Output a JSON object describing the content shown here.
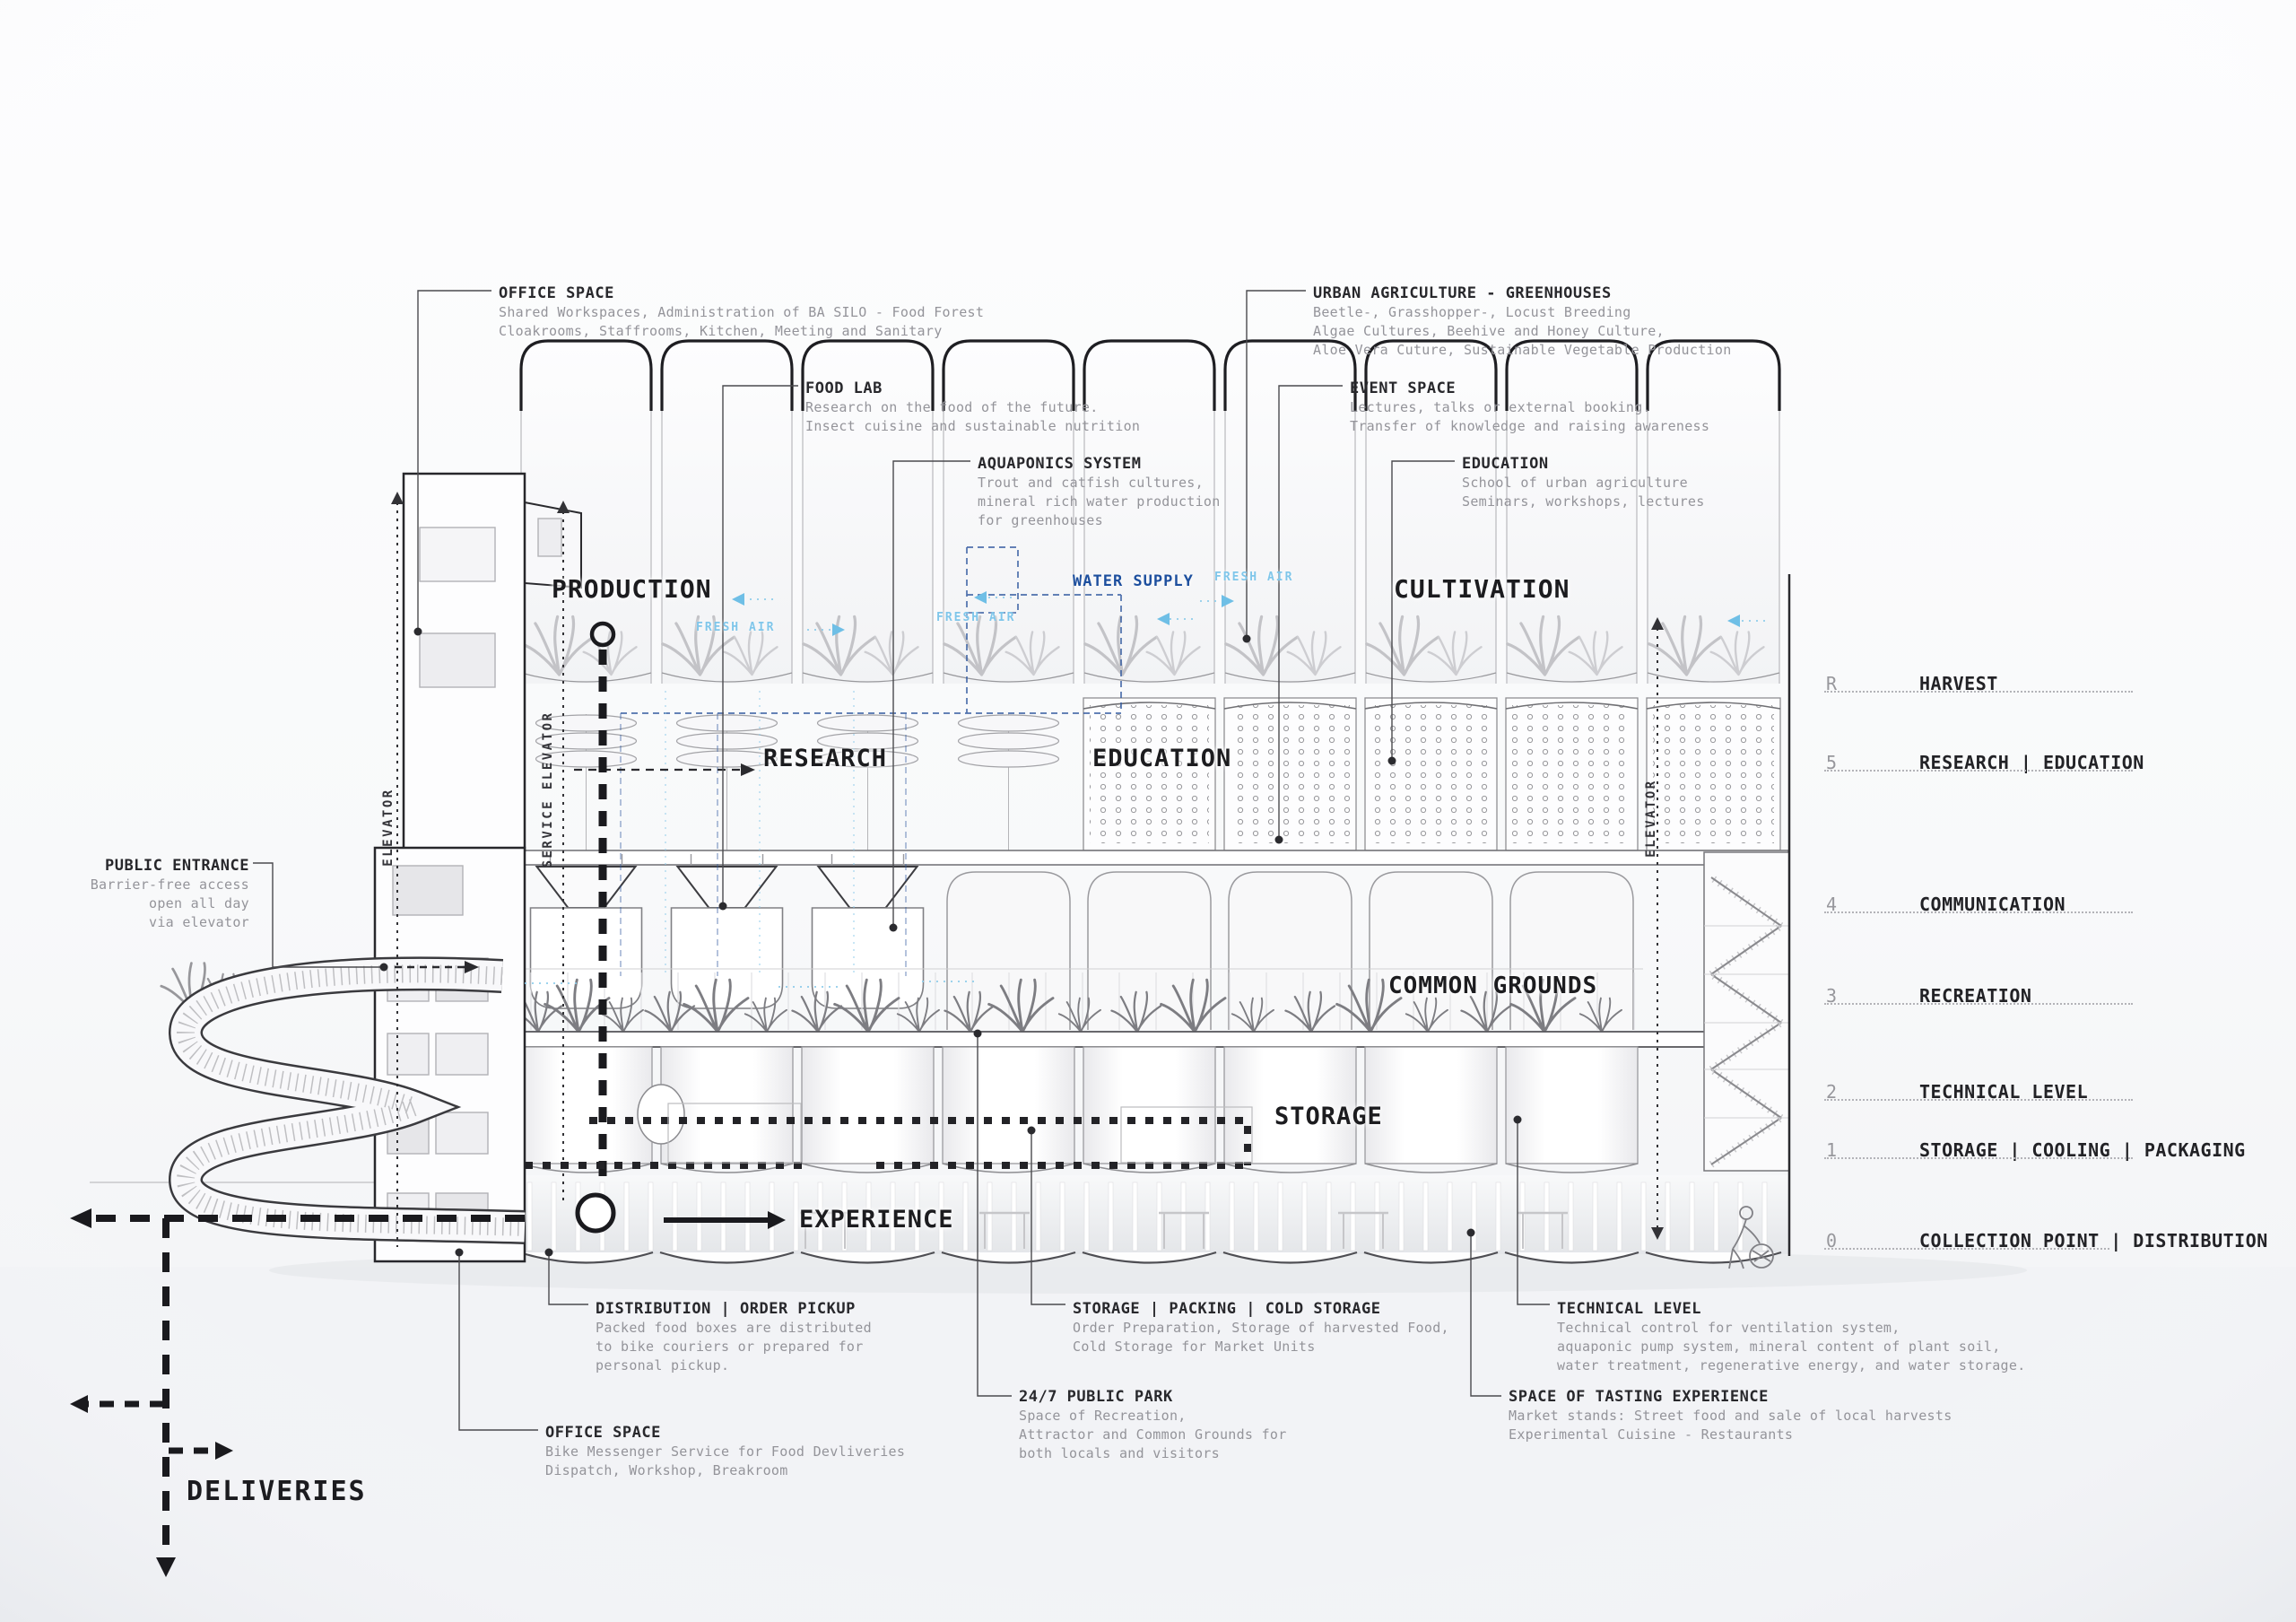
{
  "colors": {
    "accent_navy": "#1d4f9e",
    "accent_sky": "#7fc6ea",
    "ink": "#232327"
  },
  "zones": {
    "production": "PRODUCTION",
    "research": "RESEARCH",
    "education": "EDUCATION",
    "cultivation": "CULTIVATION",
    "common_grounds": "COMMON GROUNDS",
    "storage": "STORAGE",
    "experience": "EXPERIENCE"
  },
  "flows": {
    "water_supply": "WATER SUPPLY",
    "fresh_air": "FRESH AIR",
    "deliveries": "DELIVERIES"
  },
  "elevators": {
    "left": "ELEVATOR",
    "service": "SERVICE ELEVATOR",
    "right": "ELEVATOR"
  },
  "levels": [
    {
      "num": "R",
      "label": "HARVEST"
    },
    {
      "num": "5",
      "label": "RESEARCH | EDUCATION"
    },
    {
      "num": "4",
      "label": "COMMUNICATION"
    },
    {
      "num": "3",
      "label": "RECREATION"
    },
    {
      "num": "2",
      "label": "TECHNICAL LEVEL"
    },
    {
      "num": "1",
      "label": "STORAGE | COOLING | PACKAGING"
    },
    {
      "num": "0",
      "label": "COLLECTION POINT | DISTRIBUTION"
    }
  ],
  "annotations": {
    "office_space_top": {
      "title": "OFFICE SPACE",
      "lines": [
        "Shared Workspaces, Administration of BA SILO - Food Forest",
        "Cloakrooms, Staffrooms, Kitchen, Meeting and Sanitary"
      ]
    },
    "food_lab": {
      "title": "FOOD LAB",
      "lines": [
        "Research on the food of the future.",
        "Insect cuisine and sustainable nutrition"
      ]
    },
    "aquaponics": {
      "title": "AQUAPONICS SYSTEM",
      "lines": [
        "Trout and catfish cultures,",
        "mineral rich water production",
        "for greenhouses"
      ]
    },
    "urban_agriculture": {
      "title": "URBAN AGRICULTURE - GREENHOUSES",
      "lines": [
        "Beetle-, Grasshopper-, Locust Breeding",
        "Algae Cultures, Beehive and Honey Culture,",
        "Aloe Vera Cuture, Sustainable Vegetable Production"
      ]
    },
    "event_space": {
      "title": "EVENT SPACE",
      "lines": [
        "Lectures, talks or external booking.",
        "Transfer of knowledge and raising awareness"
      ]
    },
    "education_note": {
      "title": "EDUCATION",
      "lines": [
        "School of urban agriculture",
        "Seminars, workshops, lectures"
      ]
    },
    "public_entrance": {
      "title": "PUBLIC ENTRANCE",
      "lines": [
        "Barrier-free access",
        "open all day",
        "via elevator"
      ]
    },
    "distribution": {
      "title": "DISTRIBUTION | ORDER PICKUP",
      "lines": [
        "Packed food boxes are distributed",
        "to bike couriers or prepared for",
        "personal pickup."
      ]
    },
    "office_space_bottom": {
      "title": "OFFICE SPACE",
      "lines": [
        "Bike Messenger Service for Food Devliveries",
        "Dispatch, Workshop, Breakroom"
      ]
    },
    "storage_packing": {
      "title": "STORAGE | PACKING | COLD STORAGE",
      "lines": [
        "Order Preparation, Storage of harvested Food,",
        "Cold Storage for Market Units"
      ]
    },
    "public_park": {
      "title": "24/7 PUBLIC PARK",
      "lines": [
        "Space of Recreation,",
        "Attractor and Common Grounds for",
        "both locals and visitors"
      ]
    },
    "technical_level": {
      "title": "TECHNICAL LEVEL",
      "lines": [
        "Technical control for ventilation system,",
        "aquaponic pump system, mineral content of plant soil,",
        "water treatment, regenerative energy, and water storage."
      ]
    },
    "tasting": {
      "title": "SPACE OF TASTING EXPERIENCE",
      "lines": [
        "Market stands: Street food and sale of local harvests",
        "Experimental Cuisine - Restaurants"
      ]
    }
  }
}
